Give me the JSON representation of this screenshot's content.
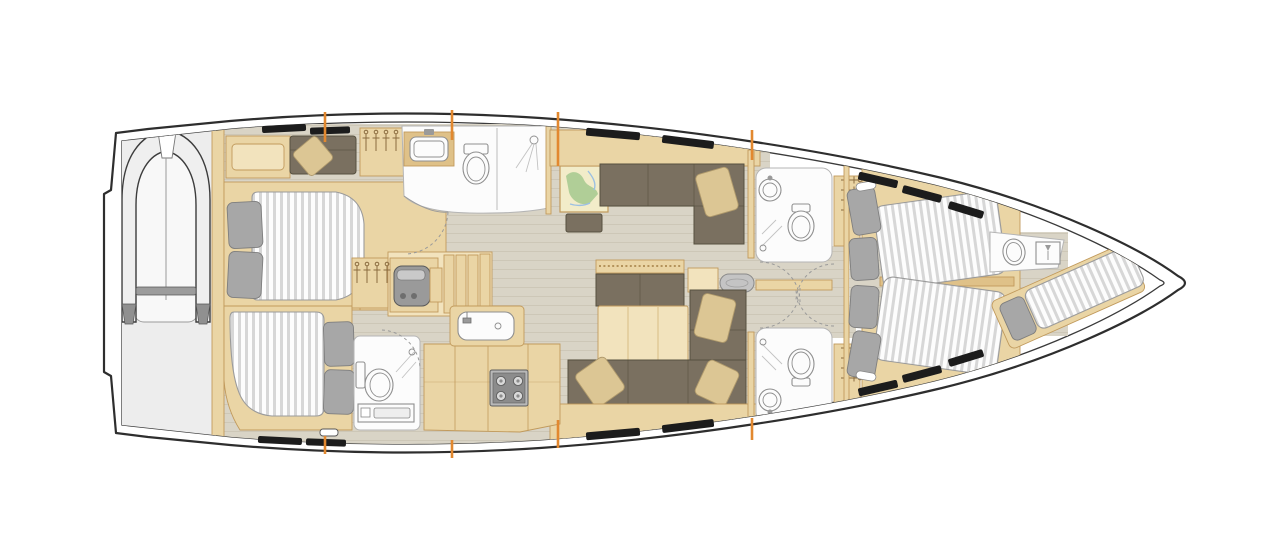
{
  "image": {
    "type": "yacht-interior-floor-plan",
    "view": "top-down",
    "orientation": "bow-right-stern-left",
    "background": "#ffffff"
  },
  "colors": {
    "hull_outline": "#2e2e2e",
    "hull_inline": "#3a3a3a",
    "floor": "#d9d4c6",
    "floor_line": "#cdc7b7",
    "garage_floor": "#ededed",
    "wood": "#ead5a5",
    "wood_light": "#f2e3bd",
    "wood_dark": "#dfc188",
    "wood_stroke": "#c19a5c",
    "sofa": "#7a7060",
    "sofa_stroke": "#56503f",
    "cushion_beige": "#dcc694",
    "cushion_stroke": "#b09a6c",
    "pillow_gray": "#a7a7a7",
    "pillow_stroke": "#7e7e7e",
    "mattress": "#fdfdfd",
    "mattress_stripe": "#d7d7d7",
    "mattress_stroke": "#9b9b9b",
    "fixture_white": "#fcfcfc",
    "fixture_stroke": "#b5b5b5",
    "fixture_line": "#8f8f8f",
    "engine": "#9a9a9a",
    "bulkhead_orange": "#e2882f",
    "hatch_black": "#1c1c1c",
    "map_base": "#f2ecc9",
    "map_green": "#a5c98e",
    "map_blue": "#9cc0e2",
    "dinghy_tube": "#efefef",
    "dinghy_tip": "#909090"
  },
  "fixtures": [
    "tender-garage",
    "inflatable-dinghy",
    "aft-cabin-port-double-berth",
    "aft-cabin-port-sofa",
    "hanging-lockers",
    "aft-cabin-starboard-double-berth",
    "aft-starboard-head",
    "day-head-sink",
    "day-head-toilet",
    "day-head-shower",
    "companionway-stairs",
    "engine",
    "galley-sink",
    "galley-stove",
    "galley-counters",
    "chart-table-with-map",
    "nav-seat",
    "salon-sofa-port",
    "salon-sofa-starboard",
    "salon-sofa-forward-facing",
    "salon-table",
    "salon-pouf",
    "throw-cushions",
    "mid-head-port",
    "mid-head-starboard",
    "owner-cabin-twin-berths",
    "bow-head-toilet",
    "bow-head-shower",
    "forepeak-berth",
    "deck-hatches",
    "bulkhead-markers"
  ]
}
